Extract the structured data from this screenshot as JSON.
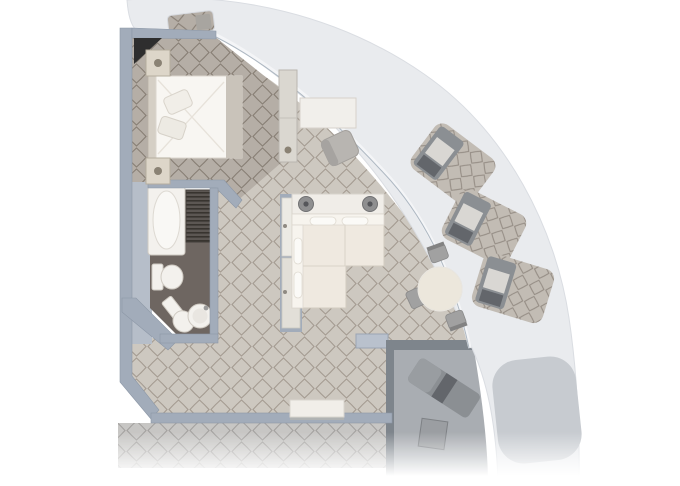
{
  "plan": {
    "kind": "suite-floor-plan",
    "rooms": [
      "bedroom",
      "bathroom",
      "hallway",
      "living-room",
      "dining-area",
      "foyer",
      "private-terrace",
      "balcony-recesses",
      "corridor"
    ],
    "furniture": {
      "bedroom": [
        "double-bed",
        "pillow-a",
        "pillow-b",
        "nightstand-upper",
        "nightstand-lower",
        "wardrobe",
        "corner-closet"
      ],
      "bathroom": [
        "bathtub",
        "slatted-closet",
        "toilet",
        "bidet",
        "washbasin"
      ],
      "living_room": [
        "desk",
        "desk-chair",
        "console-table",
        "table-lamp-left",
        "table-lamp-right",
        "sectional-sofa",
        "sofa-pillows",
        "hallway-cabinet",
        "storage-bench"
      ],
      "dining_area": [
        "round-dining-table",
        "dining-chair-north",
        "dining-chair-west",
        "dining-chair-south"
      ],
      "private_terrace": [
        "sun-lounger",
        "side-table"
      ],
      "hull_band": [
        "entry-recess",
        "entry-bench",
        "lounge-recess-upper",
        "lounge-recess-middle",
        "lounge-recess-lower",
        "hull-inset-panel"
      ]
    }
  },
  "palette": {
    "page_bg": "#ffffff",
    "hull_band": "#e9ebee",
    "hull_band_edge": "#dadde2",
    "hull_inset": "#c7cbd0",
    "window_line": "#f4f5f7",
    "window_line_inner": "#aeb8c2",
    "wall": "#a2acba",
    "wall_stroke": "#8c97a6",
    "wall_light": "#b9c1cd",
    "wall_thick": "#b6bec9",
    "terrace_wall": "#7e858c",
    "terrace_floor": "#a9adb2",
    "carpet_bedroom": "#b5aea6",
    "carpet_bedroom_line": "#877e74",
    "carpet_living": "#cdc8c0",
    "carpet_living_line": "#a49b91",
    "carpet_corridor": "#c7c6c4",
    "carpet_corridor_line": "#a3a19f",
    "carpet_balcony": "#c2bcb4",
    "carpet_balcony_line": "#948c84",
    "bath_floor": "#6e6661",
    "slats_base": "#5c5753",
    "slats_line": "#38342f",
    "fixture_white": "#f3f1ed",
    "fixture_stroke": "#cfcac2",
    "cream": "#efe9e0",
    "cream_stroke": "#d2ccc1",
    "white_soft": "#f8f6f2",
    "bed_runner": "#c9c3ba",
    "headboard": "#d5cfc5",
    "gray_furniture": "#9b9ea2",
    "gray_furniture_dark": "#7f8184",
    "lounger": "#8b8f93",
    "lounger_dark": "#63666b",
    "lounger_pad": "#d9d7d3",
    "lamp": "#8f8f90",
    "lamp_dark": "#55565a",
    "knob": "#8a8274",
    "corner_dark": "#2e2e2e",
    "table_top": "#ece7dc",
    "chair_gray": "#a1a1a1",
    "chair_gray_dark": "#828282"
  }
}
